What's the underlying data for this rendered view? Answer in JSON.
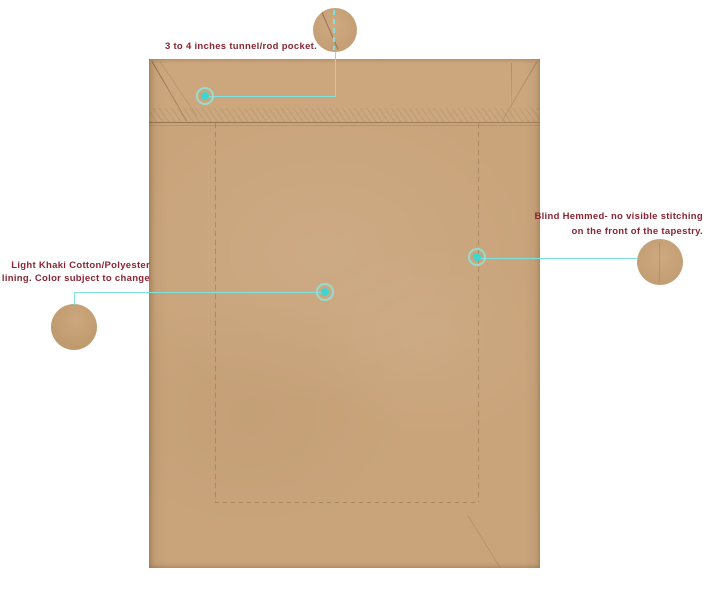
{
  "title": "Tapestry back panel construction diagram",
  "colors": {
    "background": "#ffffff",
    "fabric": "#c9a47b",
    "label_text": "#8b2533",
    "leader_line": "#7fe2df",
    "marker_dot": "#3ed5d1"
  },
  "annotations": {
    "rod_pocket": {
      "label": "3 to 4 inches tunnel/rod pocket."
    },
    "blind_hem": {
      "line1": "Blind Hemmed- no visible stitching",
      "line2": "on the front of the tapestry."
    },
    "lining": {
      "line1": "Light Khaki Cotton/Polyester",
      "line2": "lining. Color subject to change"
    }
  }
}
